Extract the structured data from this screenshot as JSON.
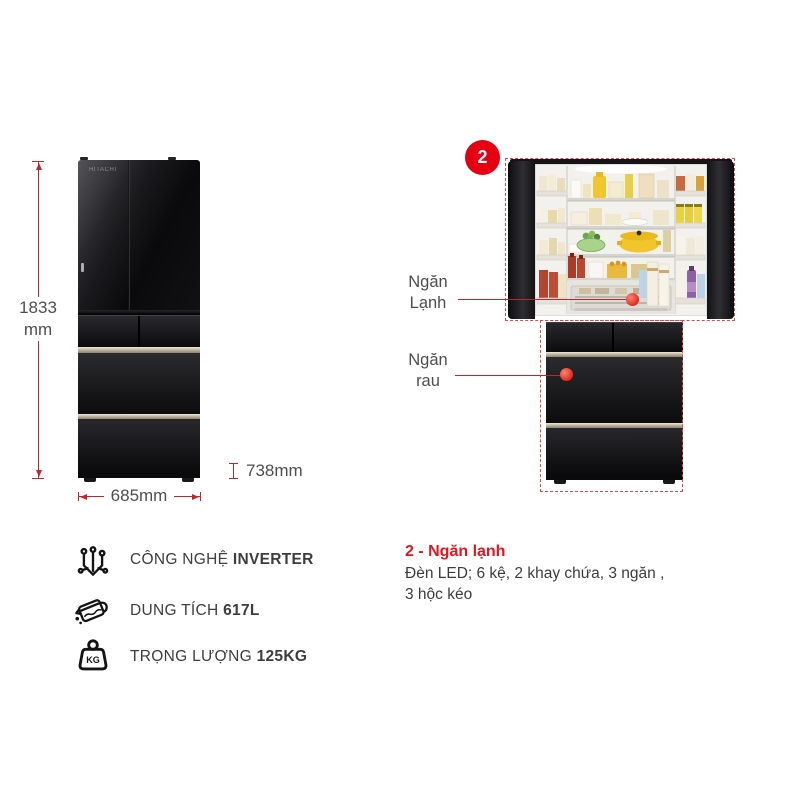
{
  "colors": {
    "accent_red": "#e60012",
    "annotation_line_red": "#c0272d",
    "dashed_outline_red": "#e64545",
    "dimension_text_gray": "#4e4e4e",
    "body_text_dark": "#3c3c3c",
    "fridge_black": "#0d0d0f"
  },
  "product": {
    "brand": "HITACHI"
  },
  "dimensions": {
    "height_value": "1833",
    "height_unit": "mm",
    "width": "685mm",
    "depth": "738mm"
  },
  "callout": {
    "badge": "2",
    "labels": [
      {
        "line1": "Ngăn",
        "line2": "Lạnh"
      },
      {
        "line1": "Ngăn",
        "line2": "rau"
      }
    ]
  },
  "features": [
    {
      "icon": "circuit-icon",
      "label": "CÔNG NGHỆ",
      "value": "INVERTER"
    },
    {
      "icon": "capacity-jug-icon",
      "label": "DUNG TÍCH",
      "value": "617L"
    },
    {
      "icon": "weight-icon",
      "icon_text": "KG",
      "label": "TRỌNG LƯỢNG",
      "value": "125KG"
    }
  ],
  "description": {
    "title": "2 - Ngăn lạnh",
    "lines": [
      "Đèn LED; 6 kệ, 2 khay chứa, 3 ngăn ,",
      "3 hộc kéo"
    ]
  }
}
